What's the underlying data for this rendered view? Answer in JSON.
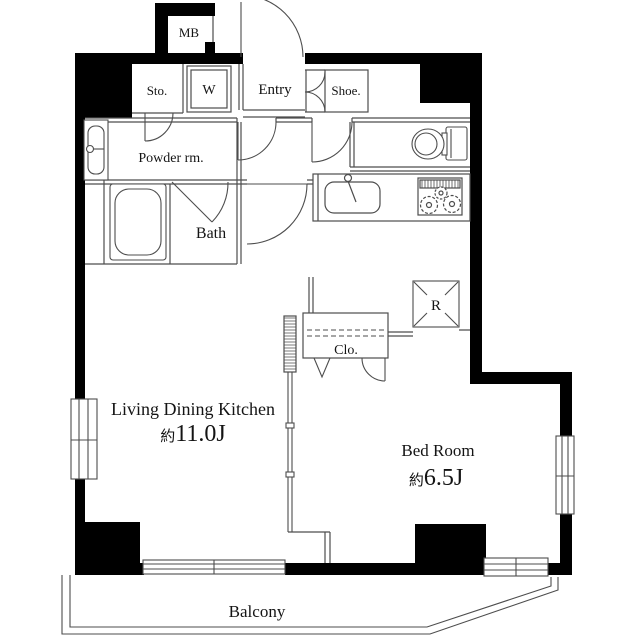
{
  "title": "Apartment floor plan",
  "colors": {
    "wall": "#000000",
    "line": "#4d4d4d",
    "text": "#141414",
    "background": "#ffffff"
  },
  "rooms": {
    "mb": {
      "label": "MB"
    },
    "storage": {
      "label": "Sto."
    },
    "washer": {
      "label": "W"
    },
    "entry": {
      "label": "Entry"
    },
    "shoe": {
      "label": "Shoe."
    },
    "powder": {
      "label": "Powder rm."
    },
    "bath": {
      "label": "Bath"
    },
    "closet": {
      "label": "Clo."
    },
    "fridge": {
      "label": "R"
    },
    "ldk": {
      "label": "Living Dining Kitchen",
      "size_prefix": "約",
      "size_value": "11.0J"
    },
    "bedroom": {
      "label": "Bed Room",
      "size_prefix": "約",
      "size_value": "6.5J"
    },
    "balcony": {
      "label": "Balcony"
    }
  }
}
